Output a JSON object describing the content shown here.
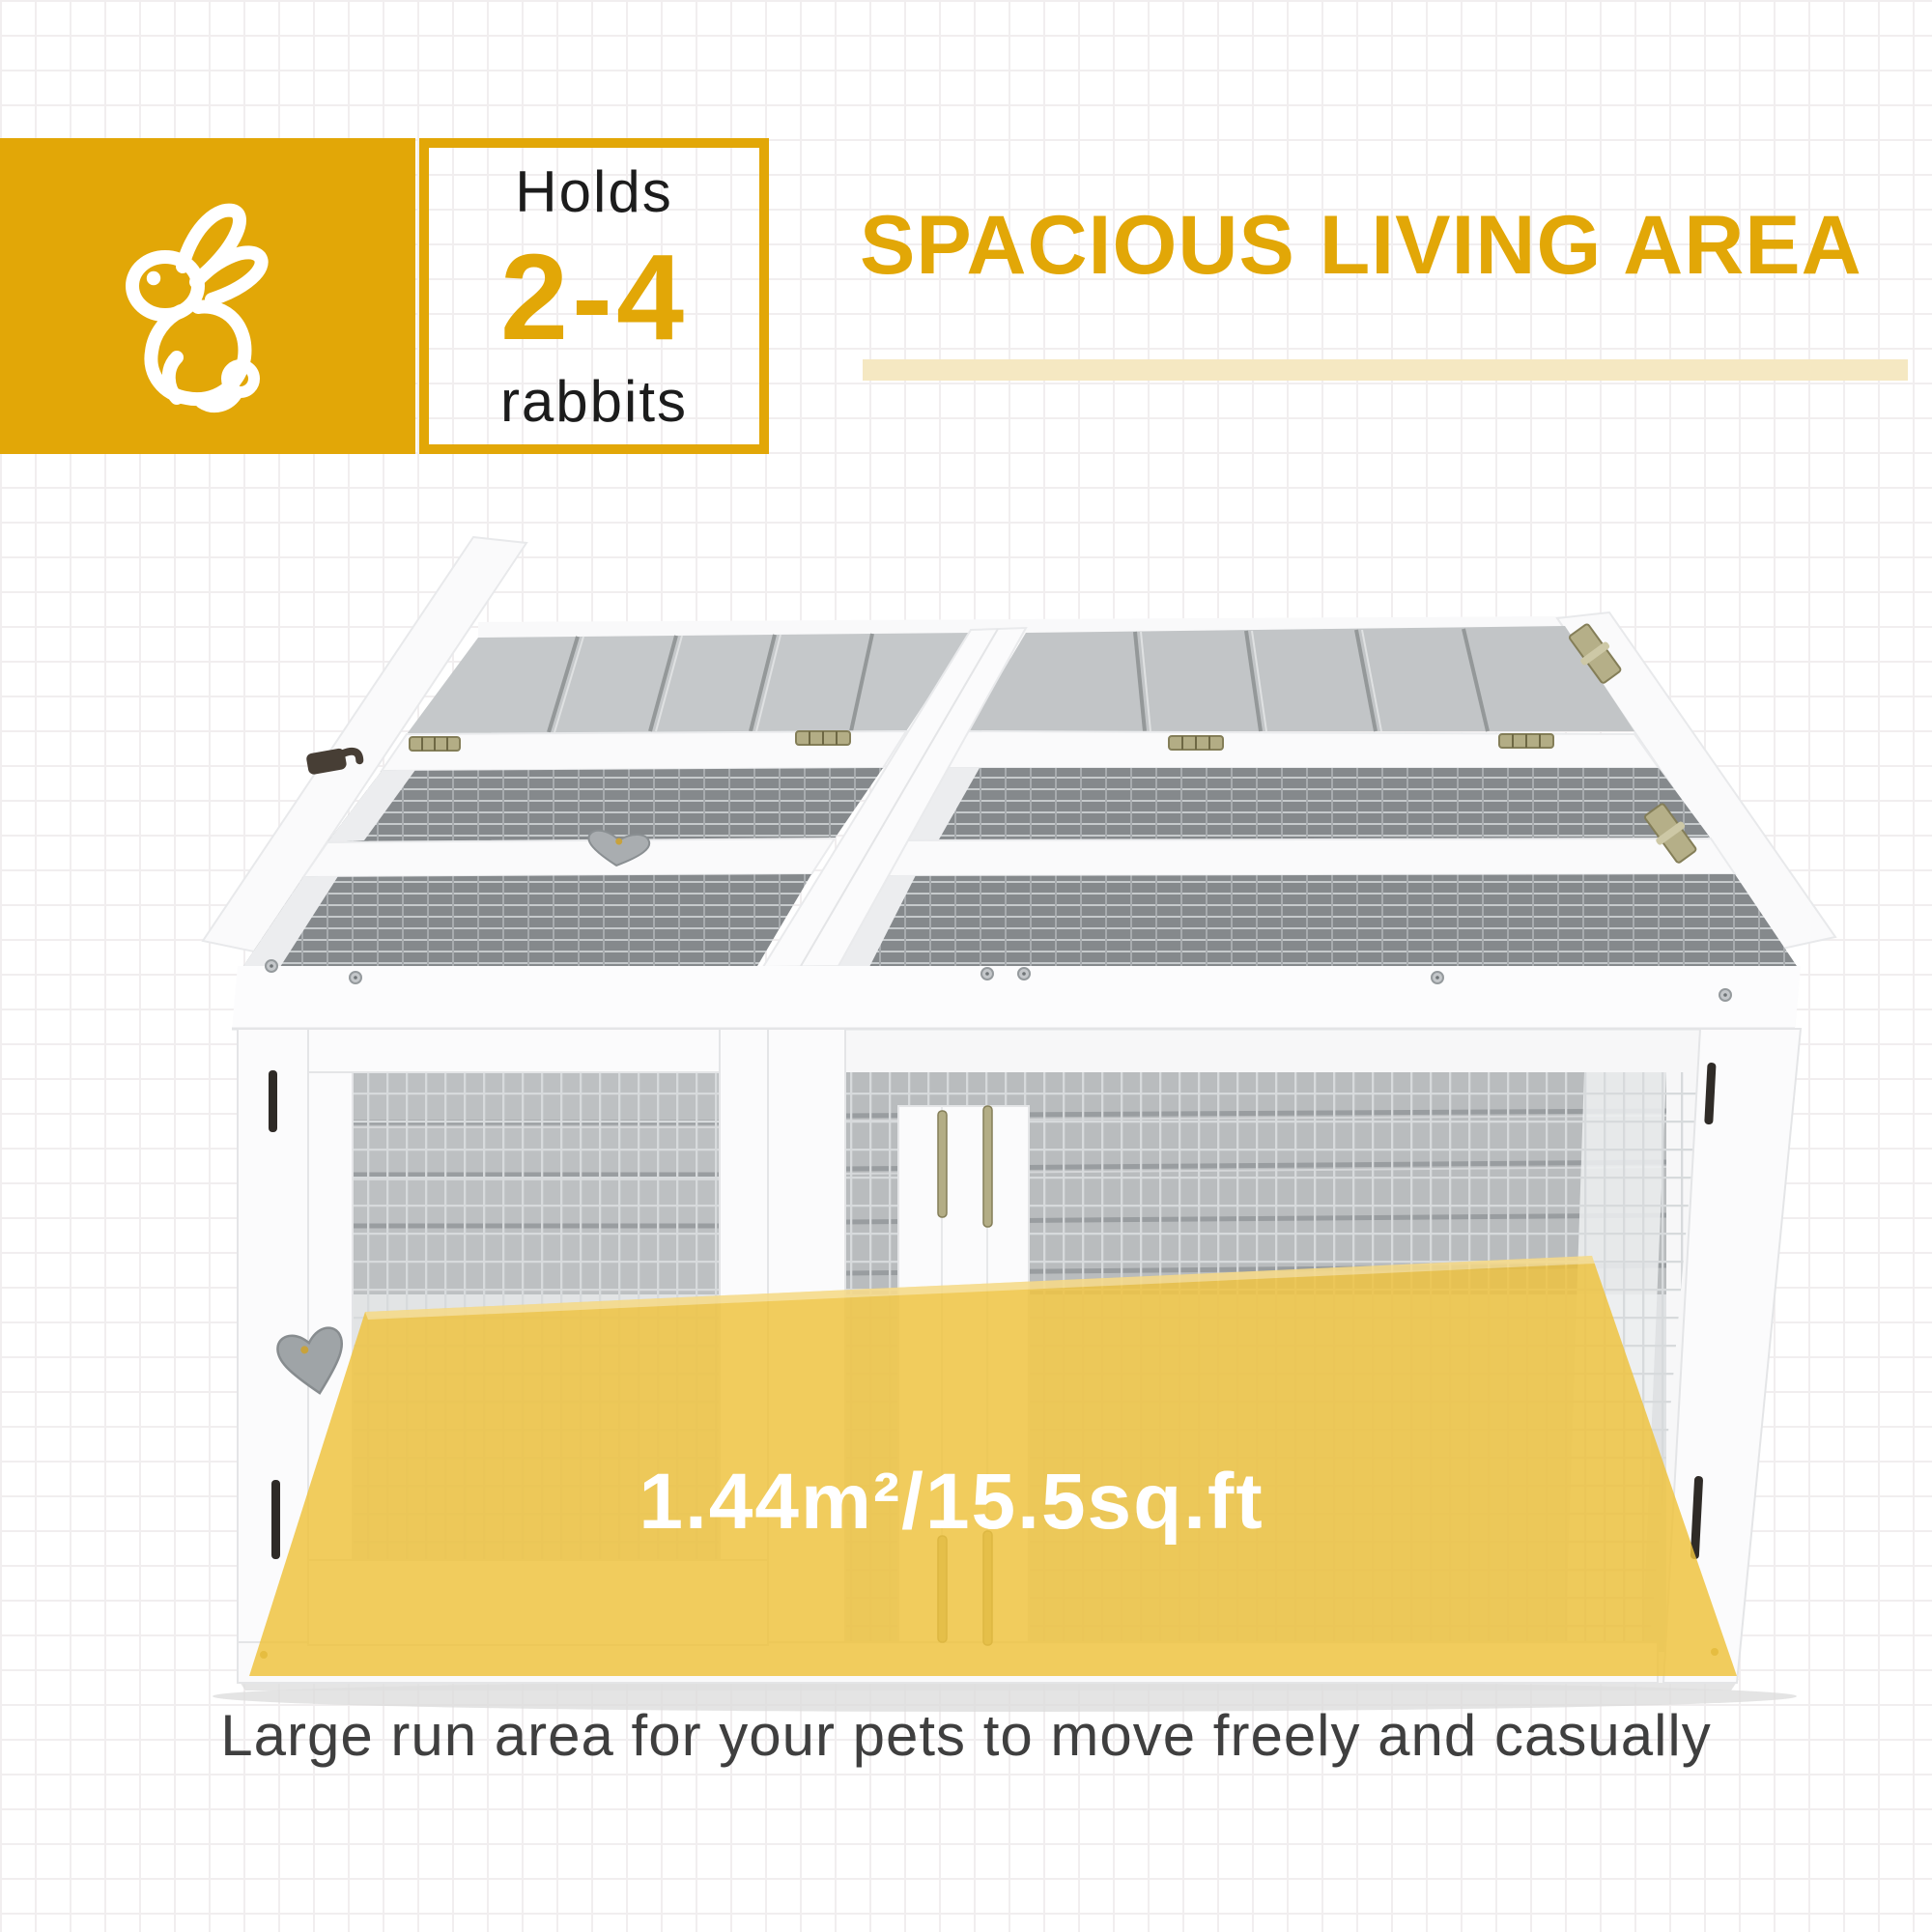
{
  "badge": {
    "holds_label": "Holds",
    "count_range": "2-4",
    "animal_label": "rabbits"
  },
  "heading": {
    "title": "SPACIOUS LIVING AREA"
  },
  "floor_highlight": {
    "area_label": "1.44m²/15.5sq.ft"
  },
  "caption": {
    "text": "Large run area for your pets to move freely and casually"
  },
  "colors": {
    "accent_gold": "#E2A707",
    "underline_cream": "#F5E8C2",
    "floor_highlight_yellow": "#EEC23E",
    "caption_gray": "#3F3F3F",
    "badge_text_dark": "#1C1C1C",
    "frame_white": "#FBFBFC",
    "wood_gray": "#C5C8CA",
    "mesh_gray": "#888C8F"
  },
  "icons": {
    "rabbit": "rabbit-icon",
    "heart_latch": "heart-latch-icon",
    "hinge": "hinge-icon",
    "lock_hook": "hook-latch-icon"
  }
}
